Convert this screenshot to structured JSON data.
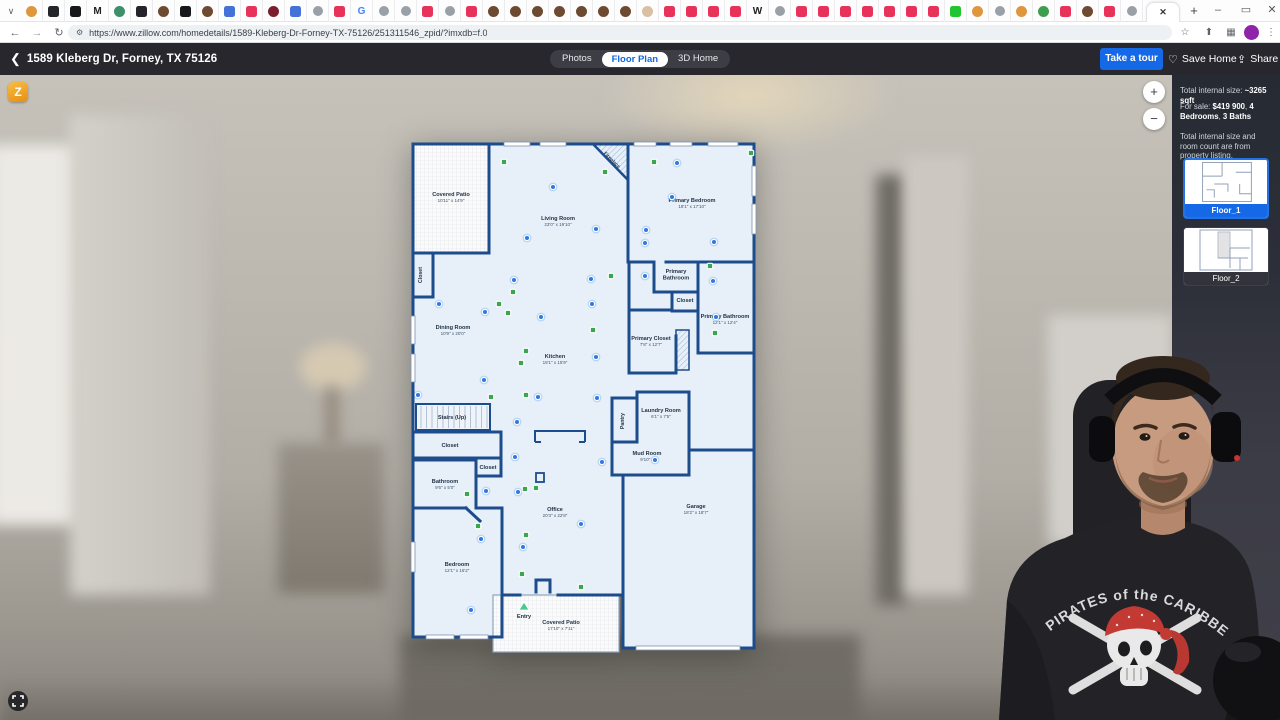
{
  "browser": {
    "url": "https://www.zillow.com/homedetails/1589-Kleberg-Dr-Forney-TX-75126/251311546_zpid/?imxdb=f.0",
    "new_tab": "+",
    "active_tab_glyph": "✕",
    "tab_search_glyph": "∨",
    "controls": {
      "minimize": "–",
      "maximize": "▭",
      "close": "✕"
    },
    "nav": {
      "back": "←",
      "forward": "→",
      "refresh": "↻",
      "home": "⌂",
      "tune": "⚙",
      "star": "☆",
      "side_panel": "⬆",
      "extensions": "▦",
      "menu": "⋮"
    },
    "favicons": [
      "d:#e0963c",
      "s:#23252a",
      "s:#17181c",
      "t:M",
      "d:#3e8f6b",
      "s:#23252a",
      "d:#6e4a31",
      "s:#17181c",
      "d:#6e4a31",
      "s:#4472d6",
      "s:#e7335a",
      "d:#7c1f2d",
      "s:#4472d6",
      "g",
      "s:#e7335a",
      "t:G",
      "g",
      "g",
      "s:#e7335a",
      "g",
      "s:#e7335a",
      "d:#6e4a31",
      "d:#6e4a31",
      "d:#6e4a31",
      "d:#6e4a31",
      "d:#6e4a31",
      "d:#6e4a31",
      "d:#6e4a31",
      "d:#d9c0a2",
      "s:#e7335a",
      "s:#e7335a",
      "s:#e7335a",
      "s:#e7335a",
      "t:W",
      "g",
      "s:#e7335a",
      "s:#e7335a",
      "s:#e7335a",
      "s:#e7335a",
      "s:#e7335a",
      "s:#e7335a",
      "s:#e7335a",
      "s:#23c431",
      "d:#e0963c",
      "g",
      "d:#e0963c",
      "d:#3d9e4f",
      "s:#e7335a",
      "d:#6e4a31",
      "s:#e7335a",
      "g"
    ]
  },
  "zillow_header": {
    "address": "1589 Kleberg Dr, Forney, TX 75126",
    "tab_photos": "Photos",
    "tab_floor_plan": "Floor Plan",
    "tab_3d": "3D Home",
    "take_a_tour": "Take a tour",
    "save_home": "Save Home",
    "share": "Share"
  },
  "sidebar": {
    "line1_label": "Total internal size: ",
    "line1_value": "~3265 sqft",
    "line2_label": "For sale: ",
    "line2_price": "$419 900",
    "line2_sep1": ", ",
    "line2_beds": "4 Bedrooms",
    "line2_sep2": ", ",
    "line2_baths": "3 Baths",
    "note": "Total internal size and room count are from property listing.",
    "floors": [
      {
        "label": "Floor_1"
      },
      {
        "label": "Floor_2"
      }
    ]
  },
  "map_controls": {
    "zoom_in": "+",
    "zoom_out": "−",
    "logo_glyph": "Z"
  },
  "floor_plan": {
    "colors": {
      "wall": "#1d4c8c",
      "room_fill": "#e7f0f9",
      "marker_blue": "#2e7be4",
      "marker_green": "#3da452",
      "entry_green": "#49c98f"
    },
    "fireplace_label": "Fireplace",
    "rooms": [
      {
        "name": "Covered Patio",
        "dims": "10'11\" x 14'9\"",
        "x": 43,
        "y": 56
      },
      {
        "name": "Living Room",
        "dims": "23'0\" x 19'10\"",
        "x": 150,
        "y": 80
      },
      {
        "name": "Primary Bedroom",
        "dims": "18'1\" x 17'10\"",
        "x": 284,
        "y": 62
      },
      {
        "name": "Dining Room",
        "dims": "10'9\" x 20'0\"",
        "x": 45,
        "y": 189
      },
      {
        "name": "Kitchen",
        "dims": "19'1\" x 15'9\"",
        "x": 147,
        "y": 218
      },
      {
        "name": "Primary Bathroom",
        "dims": "",
        "x": 268,
        "y": 133,
        "stack": true
      },
      {
        "name": "Closet",
        "dims": "",
        "x": 277,
        "y": 162
      },
      {
        "name": "Primary Bathroom",
        "dims": "12'1\" x 12'4\"",
        "x": 317,
        "y": 178
      },
      {
        "name": "Primary Closet",
        "dims": "7'8\" x 12'7\"",
        "x": 243,
        "y": 200
      },
      {
        "name": "Stairs (Up)",
        "dims": "",
        "x": 44,
        "y": 279
      },
      {
        "name": "Closet",
        "dims": "",
        "x": 42,
        "y": 307
      },
      {
        "name": "Closet",
        "dims": "",
        "x": 80,
        "y": 329
      },
      {
        "name": "Bathroom",
        "dims": "9'6\" x 5'0\"",
        "x": 37,
        "y": 343
      },
      {
        "name": "Laundry Room",
        "dims": "6'1\" x 7'5\"",
        "x": 253,
        "y": 272
      },
      {
        "name": "Mud Room",
        "dims": "9'10\" x",
        "x": 239,
        "y": 315
      },
      {
        "name": "Office",
        "dims": "20'3\" x 22'8\"",
        "x": 147,
        "y": 371
      },
      {
        "name": "Bedroom",
        "dims": "12'1\" x 16'2\"",
        "x": 49,
        "y": 426
      },
      {
        "name": "Garage",
        "dims": "18'2\" x 18'7\"",
        "x": 288,
        "y": 368
      },
      {
        "name": "Entry",
        "dims": "",
        "x": 116,
        "y": 478
      },
      {
        "name": "Covered Patio",
        "dims": "17'10\" x 7'11\"",
        "x": 153,
        "y": 484
      }
    ],
    "vertical_labels": [
      {
        "name": "Closet",
        "x": 14,
        "y": 135
      },
      {
        "name": "Pantry",
        "x": 216,
        "y": 281
      }
    ],
    "markers": {
      "blue": [
        [
          145,
          47
        ],
        [
          269,
          23
        ],
        [
          264,
          57
        ],
        [
          188,
          89
        ],
        [
          119,
          98
        ],
        [
          238,
          90
        ],
        [
          237,
          103
        ],
        [
          306,
          102
        ],
        [
          106,
          140
        ],
        [
          183,
          139
        ],
        [
          237,
          136
        ],
        [
          305,
          141
        ],
        [
          31,
          164
        ],
        [
          77,
          172
        ],
        [
          184,
          164
        ],
        [
          133,
          177
        ],
        [
          308,
          177
        ],
        [
          188,
          217
        ],
        [
          76,
          240
        ],
        [
          10,
          255
        ],
        [
          130,
          257
        ],
        [
          189,
          258
        ],
        [
          109,
          282
        ],
        [
          107,
          317
        ],
        [
          194,
          322
        ],
        [
          247,
          320
        ],
        [
          78,
          351
        ],
        [
          110,
          352
        ],
        [
          173,
          384
        ],
        [
          73,
          399
        ],
        [
          115,
          407
        ],
        [
          63,
          470
        ]
      ],
      "green": [
        [
          96,
          22
        ],
        [
          197,
          32
        ],
        [
          246,
          22
        ],
        [
          343,
          13
        ],
        [
          105,
          152
        ],
        [
          203,
          136
        ],
        [
          302,
          126
        ],
        [
          91,
          164
        ],
        [
          100,
          173
        ],
        [
          185,
          190
        ],
        [
          307,
          193
        ],
        [
          118,
          211
        ],
        [
          113,
          223
        ],
        [
          83,
          257
        ],
        [
          118,
          255
        ],
        [
          117,
          349
        ],
        [
          128,
          348
        ],
        [
          59,
          354
        ],
        [
          70,
          386
        ],
        [
          118,
          395
        ],
        [
          114,
          434
        ],
        [
          173,
          447
        ]
      ]
    },
    "entry_triangle": [
      116,
      467
    ]
  },
  "webcam": {
    "shirt_text": "PIRATES of the CARIBBEAN"
  }
}
